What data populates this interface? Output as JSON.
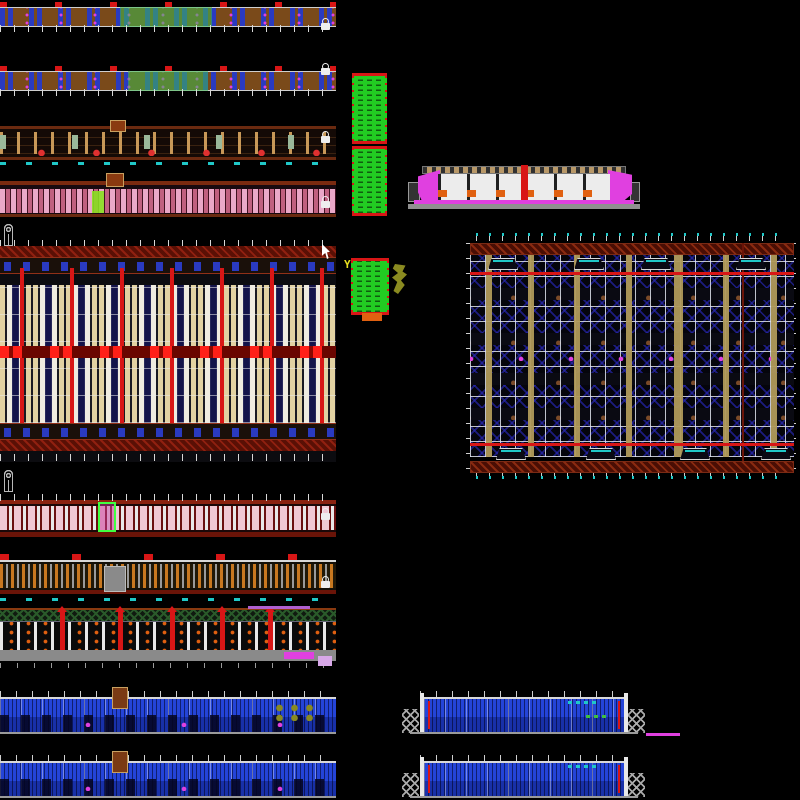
{
  "app": {
    "type": "cad-model-space",
    "description": "AutoCAD-style black model space containing multiple dense building drawings: plan strips, elevations, sections, two large framing plans, green schedule tables, a magenta cross-section and blue facade elevations",
    "visible_text": []
  },
  "palette": {
    "bg": "#000000",
    "red": "#d81616",
    "darkred": "#5a1005",
    "brown": "#7a4a1a",
    "tan": "#b09a5a",
    "blue": "#2a3ac0",
    "darkblue": "#14144a",
    "green": "#22cc22",
    "lime": "#8ae020",
    "yellow": "#e8e020",
    "olive": "#8a8a20",
    "orange": "#e06010",
    "magenta": "#e040e0",
    "pink": "#eaa8c8",
    "cyan": "#20c8c8",
    "grey": "#9a9a9a"
  },
  "symbols": {
    "hook_row_top_count": 13,
    "hook_row_bottom_count": 14,
    "green_table_3_marker": "Y"
  },
  "blocks": [
    {
      "name": "plan-strip-1"
    },
    {
      "name": "plan-strip-2"
    },
    {
      "name": "elevation-strip-1"
    },
    {
      "name": "elevation-strip-2"
    },
    {
      "name": "hook-symbols-row-1"
    },
    {
      "name": "big-floor-plan-left"
    },
    {
      "name": "hook-symbols-row-2"
    },
    {
      "name": "elevation-strip-3"
    },
    {
      "name": "elevation-strip-4"
    },
    {
      "name": "section-strip"
    },
    {
      "name": "blue-elevation-left-1"
    },
    {
      "name": "blue-elevation-left-2"
    },
    {
      "name": "green-schedule-table-1"
    },
    {
      "name": "green-schedule-table-2"
    },
    {
      "name": "green-schedule-table-3"
    },
    {
      "name": "magenta-cross-section"
    },
    {
      "name": "roof-framing-plan-right"
    },
    {
      "name": "blue-elevation-right-1"
    },
    {
      "name": "blue-elevation-right-2"
    }
  ]
}
